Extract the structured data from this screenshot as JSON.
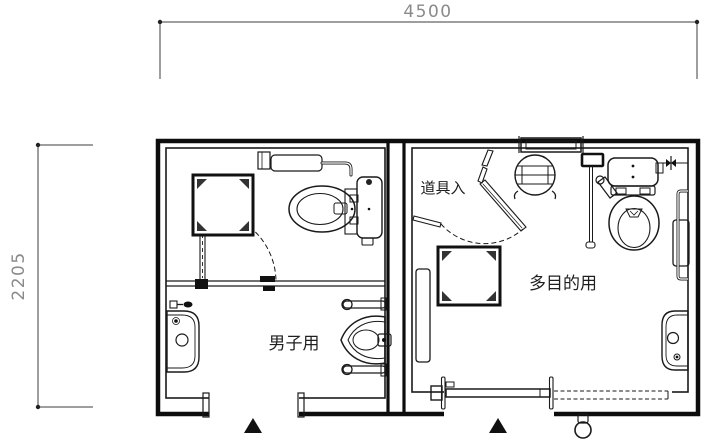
{
  "drawing": {
    "type": "architectural-floor-plan",
    "background": "#ffffff",
    "line_color": "#1a1a1a",
    "dimension_color": "#8a8a8a"
  },
  "dimensions": {
    "top_width": "4500",
    "left_height": "2205"
  },
  "rooms": {
    "mens": {
      "label": "男子用",
      "fixtures": [
        "corner-box",
        "swing-door",
        "wall-shelf-grab-rail",
        "toilet",
        "washbasin",
        "urinal-with-grab-bars",
        "entrance-arrow"
      ]
    },
    "multipurpose": {
      "label": "多目的用",
      "tool_entry_label": "道具入",
      "fixtures": [
        "folding-door",
        "corner-box",
        "round-stool",
        "transom-window",
        "wall-control-box",
        "vertical-grab-bar",
        "toilet-with-cistern",
        "l-grab-bar",
        "backrest-panel",
        "washbasin",
        "mirror-panel",
        "sliding-door",
        "door-operator-knob",
        "entrance-arrow"
      ]
    }
  }
}
